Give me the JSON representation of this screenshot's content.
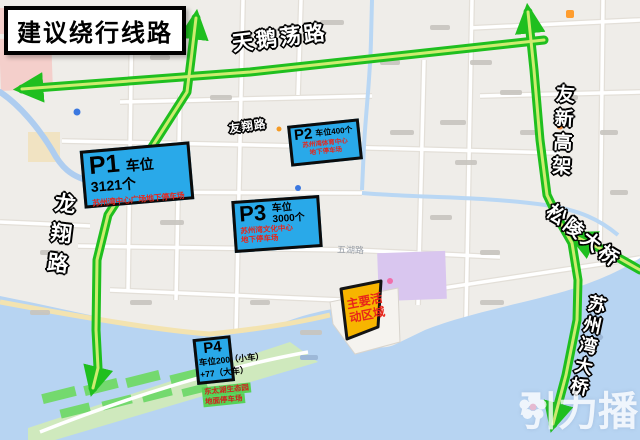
{
  "banner": {
    "title": "建议绕行线路"
  },
  "road_labels": {
    "tianedanglu": "天鹅荡路",
    "youxin_gaojia": "友新高架",
    "songling_bridge": "松陵大桥",
    "suzhouwan_bridge": "苏州湾大桥",
    "longxianglu": "龙翔路",
    "youxianglu": "友翔路",
    "wuhulu": "五湖路"
  },
  "parking_lots": [
    {
      "id": "P1",
      "capacity": "车位3121个",
      "name": "苏州湾中心广场地下停车场"
    },
    {
      "id": "P2",
      "capacity": "车位400个",
      "name_line1": "苏州湾体育中心",
      "name_line2": "地下停车场"
    },
    {
      "id": "P3",
      "capacity_line1": "车位",
      "capacity_line2": "3000个",
      "name_line1": "苏州湾文化中心",
      "name_line2": "地下停车场"
    },
    {
      "id": "P4",
      "capacity_line1": "车位200（小车）",
      "capacity_line2": "+77（大车）",
      "note_line1": "东太湖生态园",
      "note_line2": "地面停车场"
    }
  ],
  "activity_area": {
    "line1": "主要活",
    "line2": "动区域"
  },
  "watermark": {
    "brand": "引力播"
  },
  "colors": {
    "route_green": "#1fbf1f",
    "route_stripe": "#cdec6f",
    "parking_blue": "#29a9e9",
    "activity_yellow": "#f7b500",
    "alert_red": "#e8251a",
    "water_blue": "#b7d4f2"
  }
}
